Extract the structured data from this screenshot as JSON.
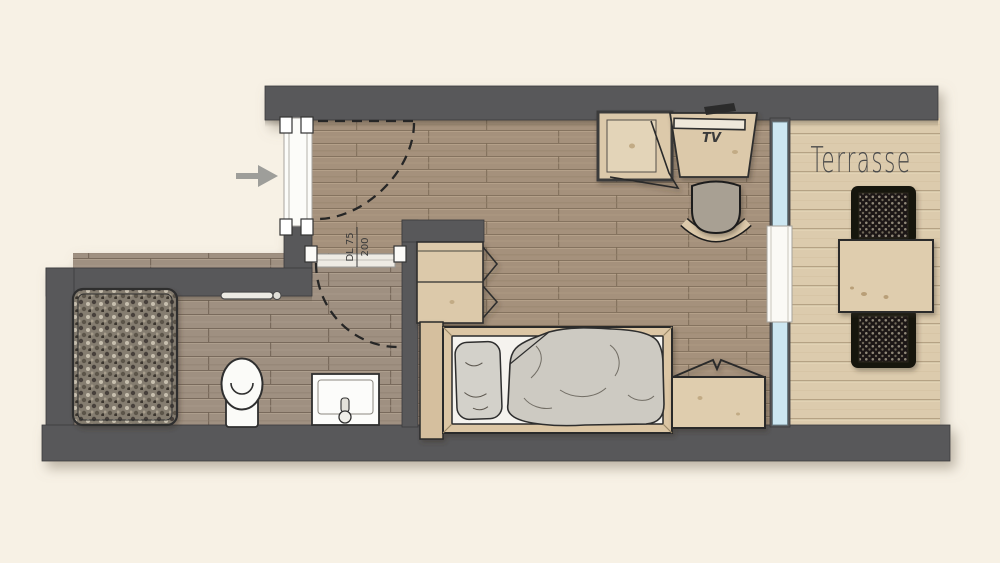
{
  "plan": {
    "labels": {
      "terrace": "Terrasse",
      "tv": "TV",
      "door_width": "DL 75",
      "door_height": "200"
    },
    "colors": {
      "background": "#f7f1e5",
      "wall": "#59595a",
      "floor_main": "#a5917b",
      "floor_bath": "#9f9081",
      "floor_terrace": "#dccbad",
      "glass": "#cde7f2",
      "furniture_wood": "#dcc9aa",
      "fabric": "#cdcac2",
      "mesh_chair": "#1b1813",
      "fixture_white": "#fbfbf8",
      "dash_line": "#262626"
    }
  }
}
